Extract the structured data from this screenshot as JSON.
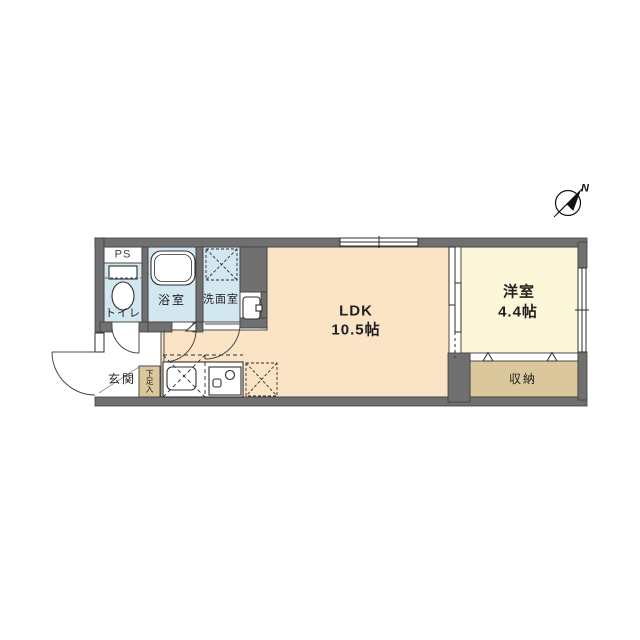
{
  "floorplan": {
    "labels": {
      "ps": "PS",
      "toilet": "トイレ",
      "bath": "浴室",
      "washroom": "洗面室",
      "entrance": "玄関",
      "shoe_box": "下足入",
      "ldk_name": "LDK",
      "ldk_size": "10.5帖",
      "western_name": "洋室",
      "western_size": "4.4帖",
      "closet": "収納",
      "north": "N"
    },
    "colors": {
      "wall": "#707070",
      "wet_floor": "#d3e7f0",
      "ldk_floor": "#fbe4c6",
      "western_floor": "#fbf7d8",
      "storage_floor": "#dbc79c",
      "white": "#ffffff",
      "line": "#3f3f3f"
    }
  }
}
